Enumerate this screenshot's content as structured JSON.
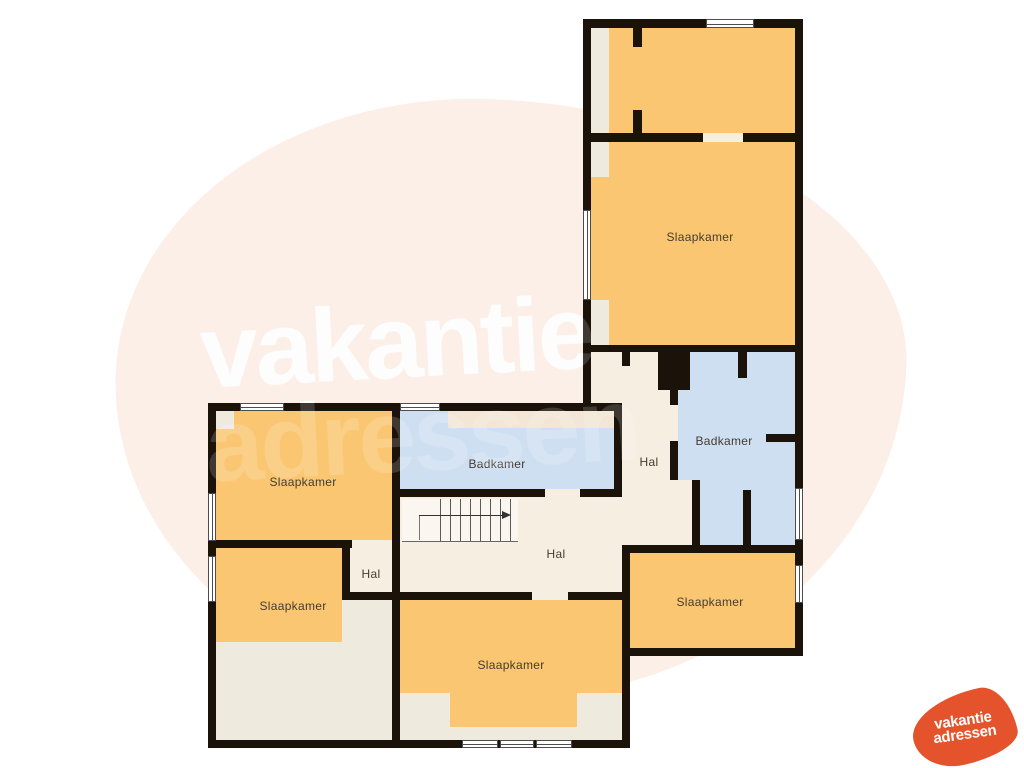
{
  "page": {
    "type": "floor-plan",
    "floor": "verdieping"
  },
  "watermark": {
    "line1": "vakantie",
    "line2": "adressen"
  },
  "logo": {
    "line1": "vakantie",
    "line2": "adressen"
  },
  "rooms": {
    "slaapkamer_ne": {
      "label": "Slaapkamer"
    },
    "badkamer_right": {
      "label": "Badkamer"
    },
    "hal_right": {
      "label": "Hal"
    },
    "slaapkamer_se": {
      "label": "Slaapkamer"
    },
    "slaapkamer_nw": {
      "label": "Slaapkamer"
    },
    "badkamer_center": {
      "label": "Badkamer"
    },
    "hal_center": {
      "label": "Hal"
    },
    "hal_small": {
      "label": "Hal"
    },
    "slaapkamer_sw": {
      "label": "Slaapkamer"
    },
    "slaapkamer_s": {
      "label": "Slaapkamer"
    }
  },
  "colors": {
    "room_orange": "#FAC671",
    "room_blue": "#CFDFF2",
    "hall_cream": "#F7EEE2",
    "roof_cream": "#EFEADE",
    "tan_strip": "#F3E6D4",
    "wall": "#1B120A",
    "blob": "#FCEFE8",
    "logo_orange": "#E4532B",
    "label": "#453C30",
    "stair_bg": "#FBF7F0"
  }
}
